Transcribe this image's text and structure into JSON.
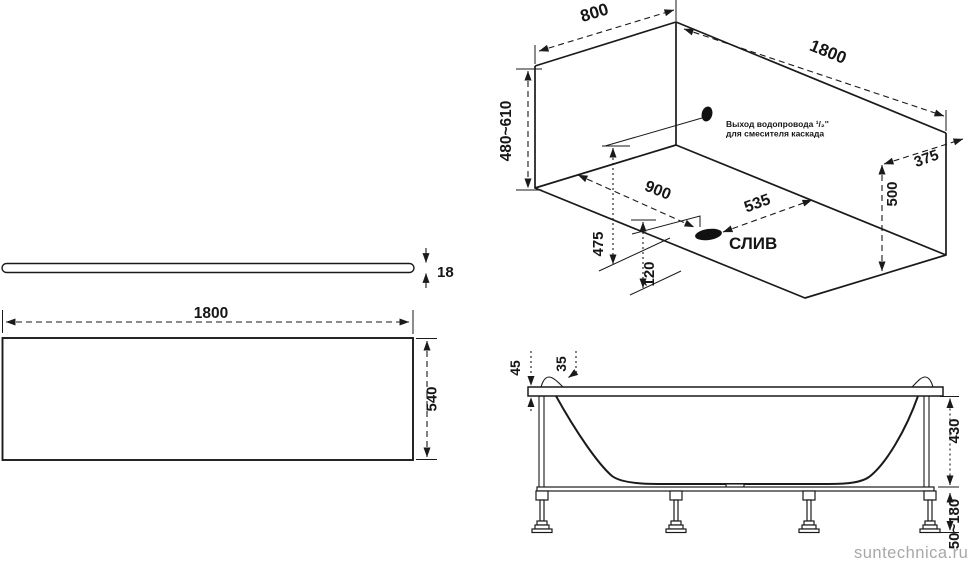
{
  "views": {
    "isometric": {
      "dims": {
        "width_top": "800",
        "length_top": "1800",
        "height_range": "480~610",
        "edge_offset": "375",
        "depth": "500",
        "drain_from_end": "900",
        "drain_from_side": "535",
        "outlet_height": "475",
        "drain_height": "120"
      },
      "drain_label": "СЛИВ",
      "outlet_note_line1": "Выход водопровода ¹/₂''",
      "outlet_note_line2": "для смесителя каскада"
    },
    "panel_side": {
      "thickness": "18"
    },
    "panel_front": {
      "length": "1800",
      "height": "540"
    },
    "section": {
      "rim_thickness": "45",
      "headrest_height": "35",
      "body_height": "430",
      "legs_range": "50~180"
    }
  },
  "watermark": "suntechnica.ru",
  "colors": {
    "line": "#1a1a1a",
    "watermark": "#a8a8a8",
    "background": "#ffffff"
  }
}
